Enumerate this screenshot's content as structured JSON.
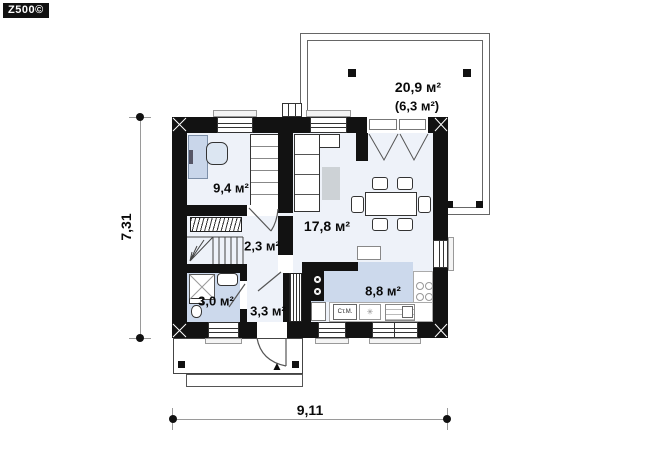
{
  "logo": {
    "text": "Z500©"
  },
  "rooms": [
    {
      "key": "cabinet",
      "area": "9,4 м²"
    },
    {
      "key": "living_room",
      "area": "17,8 м²"
    },
    {
      "key": "stair_hall",
      "area": "2,3 м²"
    },
    {
      "key": "bathroom",
      "area": "3,0 м²"
    },
    {
      "key": "hallway",
      "area": "3,3 м²"
    },
    {
      "key": "kitchen",
      "area": "8,8 м²"
    }
  ],
  "terrace": {
    "area": "20,9 м²",
    "secondary_area": "(6,3 м²)"
  },
  "dimensions": {
    "width": "9,11",
    "height": "7,31"
  },
  "kitchen_labels": {
    "washing_machine": "Ст.М.",
    "fridge_icon": "✳"
  },
  "entrance": {
    "arrow_icon": "▲"
  },
  "colors": {
    "wall": "#121212",
    "floor_tint": "#eef2f9",
    "wet_floor_tint": "#ccd9ec",
    "furniture_accent": "#c9d6ea",
    "rug": "#cdd2d6",
    "terrace_outline": "#666666",
    "dimension_line": "#9a9a9a"
  }
}
